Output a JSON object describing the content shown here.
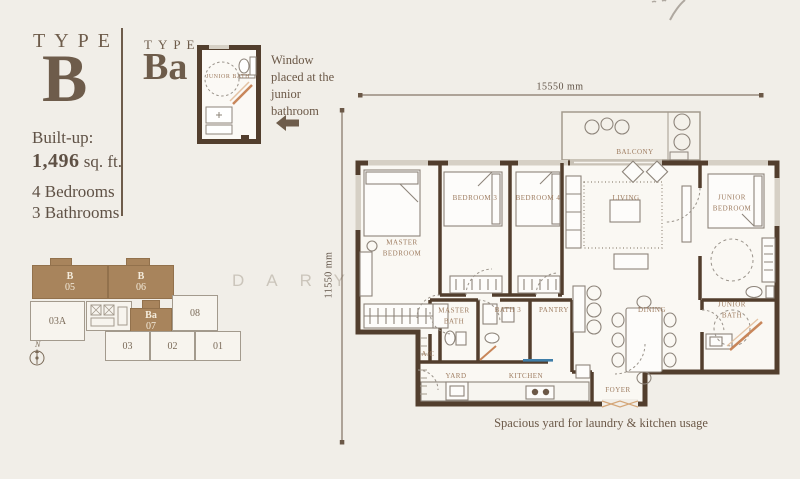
{
  "info_panel": {
    "type_label": "TYPE",
    "type_letter": "B",
    "built_up_label": "Built-up:",
    "built_up_value": "1,496",
    "built_up_unit": " sq. ft.",
    "bedrooms": "4 Bedrooms",
    "bathrooms": "3 Bathrooms"
  },
  "variant": {
    "type_label": "TYPE",
    "type_letter": "Ba",
    "note": "Window placed at the junior bathroom",
    "mini_room": "JUNIOR BATH"
  },
  "key_plan": {
    "north_label": "N",
    "units": [
      {
        "type": "B",
        "id": "05"
      },
      {
        "type": "B",
        "id": "06"
      },
      {
        "type": "Ba",
        "id": "07"
      },
      {
        "type": "",
        "id": "08"
      },
      {
        "type": "",
        "id": "03A"
      },
      {
        "type": "",
        "id": "03"
      },
      {
        "type": "",
        "id": "02"
      },
      {
        "type": "",
        "id": "01"
      }
    ]
  },
  "floor_plan": {
    "width_dim": "15550 mm",
    "height_dim": "11550 mm",
    "labels": {
      "balcony": "BALCONY",
      "master_bedroom": "MASTER BEDROOM",
      "bedroom3": "BEDROOM 3",
      "bedroom4": "BEDROOM 4",
      "living": "LIVING",
      "junior_bedroom": "JUNIOR BEDROOM",
      "master_bath": "MASTER BATH",
      "bath3": "BATH 3",
      "pantry": "PANTRY",
      "dining": "DINING",
      "junior_bath": "JUNIOR BATH",
      "ac": "A/C",
      "yard": "YARD",
      "kitchen": "KITCHEN",
      "foyer": "FOYER"
    },
    "caption": "Spacious yard for laundry & kitchen usage"
  },
  "watermark": "DARYL TOH",
  "colors": {
    "background": "#f1eee8",
    "wall": "#523e2d",
    "accent_text": "#6e5c4b",
    "keyplan_highlight": "#a8845c",
    "room_label": "#9d7b5f",
    "light_line": "#a39a8d",
    "shower_screen": "#c8865a",
    "sink_blue": "#3f7ea8",
    "watermark": "#cbc5bb"
  }
}
